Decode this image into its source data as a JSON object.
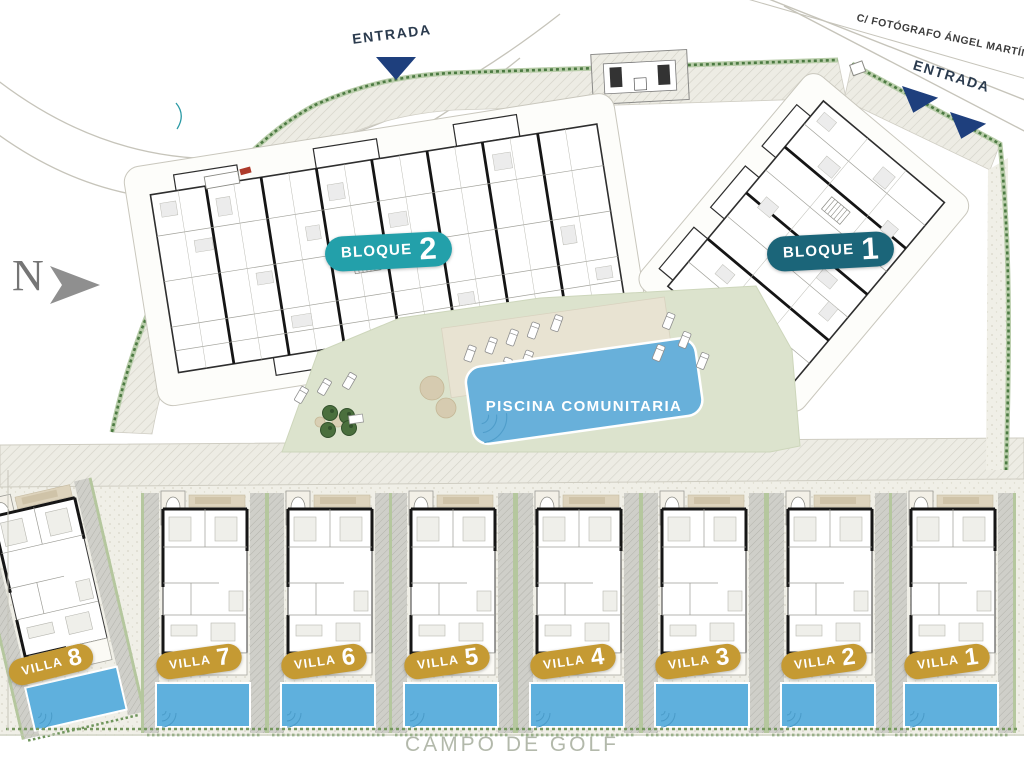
{
  "labels": {
    "street": "C/ FOTÓGRAFO ÁNGEL MARTÍN",
    "entrance_top": "ENTRADA",
    "entrance_right": "ENTRADA",
    "north": "N",
    "pool": "PISCINA COMUNITARIA",
    "golf": "CAMPO DE GOLF"
  },
  "blocks": [
    {
      "name": "BLOQUE",
      "number": "2",
      "badge_color": "#23a0aa"
    },
    {
      "name": "BLOQUE",
      "number": "1",
      "badge_color": "#1b6579"
    }
  ],
  "villas": [
    {
      "name": "VILLA",
      "number": "8"
    },
    {
      "name": "VILLA",
      "number": "7"
    },
    {
      "name": "VILLA",
      "number": "6"
    },
    {
      "name": "VILLA",
      "number": "5"
    },
    {
      "name": "VILLA",
      "number": "4"
    },
    {
      "name": "VILLA",
      "number": "3"
    },
    {
      "name": "VILLA",
      "number": "2"
    },
    {
      "name": "VILLA",
      "number": "1"
    }
  ],
  "colors": {
    "villa_badge": "#c59a33",
    "block2_badge": "#23a0aa",
    "block1_badge": "#1b6579",
    "pool_water": "#68b0da",
    "entrance_arrow": "#1e3f7d",
    "lawn": "#dce3cd",
    "hedge": "#4c7a42",
    "golf_text": "#b3b9ab"
  }
}
